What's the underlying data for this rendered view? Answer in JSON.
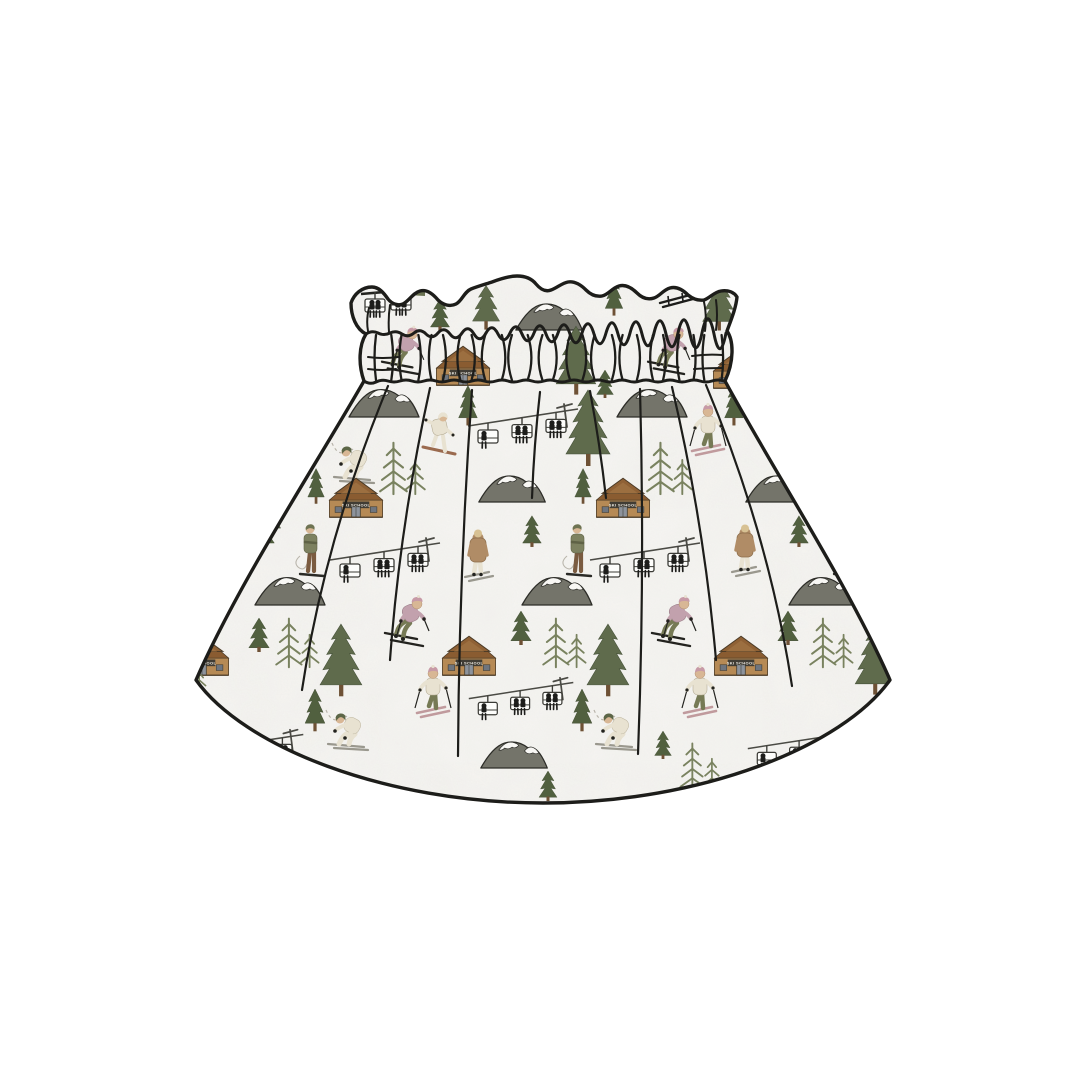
{
  "page": {
    "background": "#ffffff"
  },
  "product": {
    "name": "paperbag-waist-skirt-mockup",
    "print_theme": "ski-resort",
    "cabin_sign_text": "SKI SCHOOL"
  },
  "palette": {
    "fabric": "#f6f5f2",
    "fabric_blotch": "#dcdad4",
    "outline": "#1d1d1a",
    "tree_dark": "#51603f",
    "tree_mid": "#5f6b4c",
    "tree_light": "#79825f",
    "trunk": "#6e5135",
    "mountain": "#74746a",
    "snow": "#f8f7f4",
    "cabin_wall": "#b68a55",
    "cabin_wall_light": "#9c6f40",
    "cabin_roof": "#8f6135",
    "cabin_sign": "#403c34",
    "cabin_sign_text_color": "#efece4",
    "cabin_door": "#8d939c",
    "lift_metal": "#4a4a44",
    "chair_fill": "#fdfdfb",
    "silhouette": "#1d1d1b",
    "jacket_mauve": "#c2a1ad",
    "hat_pink": "#c79aa6",
    "pants_olive": "#767a55",
    "cream": "#e8e2d1",
    "tan_coat": "#b08c66",
    "skin": "#d8b795",
    "hair_blonde": "#d7c193",
    "board_red": "#9a6a4e",
    "ski_pink": "#c09a9d",
    "ski_gray": "#9a988e",
    "sweater_olive": "#7d8160",
    "pants_brown": "#7a5b40",
    "trail": "#b9b5ab"
  },
  "waistband": {
    "x1": 366,
    "x2": 726,
    "top": 334,
    "bottom": 381,
    "fold_count": 26
  },
  "gathers": [
    [
      388,
      386,
      302,
      690,
      -20
    ],
    [
      430,
      388,
      390,
      660,
      -10
    ],
    [
      472,
      390,
      458,
      756,
      -6
    ],
    [
      540,
      392,
      532,
      498,
      -2
    ],
    [
      590,
      391,
      606,
      498,
      2
    ],
    [
      640,
      389,
      638,
      754,
      6
    ],
    [
      672,
      387,
      716,
      660,
      10
    ],
    [
      706,
      385,
      792,
      686,
      20
    ]
  ],
  "motifs": [
    {
      "t": "liftChairs",
      "x": 393,
      "y": 318,
      "s": 1
    },
    {
      "t": "skiRack",
      "x": 676,
      "y": 308,
      "s": 1
    },
    {
      "t": "pineSmall",
      "x": 440,
      "y": 331,
      "s": 0.8
    },
    {
      "t": "spruceMd",
      "x": 486,
      "y": 333,
      "s": 0.85
    },
    {
      "t": "mountain",
      "x": 549,
      "y": 331,
      "s": 0.95
    },
    {
      "t": "spruceThin",
      "x": 614,
      "y": 318,
      "s": 0.8
    },
    {
      "t": "spruceLg",
      "x": 719,
      "y": 335,
      "s": 0.75
    },
    {
      "t": "skierJump",
      "x": 402,
      "y": 375,
      "s": 0.95
    },
    {
      "t": "cabin",
      "x": 463,
      "y": 389,
      "s": 0.95
    },
    {
      "t": "spruceLg",
      "x": 576,
      "y": 400,
      "s": 0.9
    },
    {
      "t": "pineSmall",
      "x": 605,
      "y": 398,
      "s": 0.7
    },
    {
      "t": "skierJump",
      "x": 668,
      "y": 375,
      "s": 0.95
    },
    {
      "t": "cabin",
      "x": 740,
      "y": 392,
      "s": 0.95
    },
    {
      "t": "mountain",
      "x": 384,
      "y": 418,
      "s": 1
    },
    {
      "t": "mountain",
      "x": 652,
      "y": 418,
      "s": 1
    },
    {
      "t": "snowboarder",
      "x": 440,
      "y": 457,
      "s": 1
    },
    {
      "t": "chairlift",
      "x": 523,
      "y": 458,
      "s": 1
    },
    {
      "t": "spruceLg",
      "x": 588,
      "y": 472,
      "s": 1
    },
    {
      "t": "spruceThin",
      "x": 468,
      "y": 428,
      "s": 0.85
    },
    {
      "t": "spruceThin",
      "x": 734,
      "y": 428,
      "s": 0.85
    },
    {
      "t": "skierSlalom",
      "x": 708,
      "y": 458,
      "s": 1
    },
    {
      "t": "skierCrouch",
      "x": 354,
      "y": 483,
      "s": 1
    },
    {
      "t": "spruceMd",
      "x": 851,
      "y": 470,
      "s": 0.9
    },
    {
      "t": "sparsePair",
      "x": 402,
      "y": 496,
      "s": 0.95
    },
    {
      "t": "sparsePair",
      "x": 669,
      "y": 496,
      "s": 0.95
    },
    {
      "t": "spruceThin",
      "x": 316,
      "y": 506,
      "s": 0.75
    },
    {
      "t": "spruceThin",
      "x": 583,
      "y": 506,
      "s": 0.75
    },
    {
      "t": "spruceThin",
      "x": 850,
      "y": 506,
      "s": 0.75
    },
    {
      "t": "mountain",
      "x": 245,
      "y": 503,
      "s": 0.95
    },
    {
      "t": "mountain",
      "x": 512,
      "y": 503,
      "s": 0.95
    },
    {
      "t": "mountain",
      "x": 779,
      "y": 503,
      "s": 0.95
    },
    {
      "t": "cabin",
      "x": 356,
      "y": 521,
      "s": 0.95
    },
    {
      "t": "cabin",
      "x": 623,
      "y": 521,
      "s": 0.95
    },
    {
      "t": "cabin",
      "x": 884,
      "y": 521,
      "s": 0.95
    },
    {
      "t": "spruceMd",
      "x": 267,
      "y": 540,
      "s": 0.85
    },
    {
      "t": "pineSmall",
      "x": 532,
      "y": 547,
      "s": 0.78
    },
    {
      "t": "pineSmall",
      "x": 265,
      "y": 547,
      "s": 0.78
    },
    {
      "t": "pineSmall",
      "x": 799,
      "y": 547,
      "s": 0.78
    },
    {
      "t": "walker",
      "x": 478,
      "y": 583,
      "s": 1
    },
    {
      "t": "walker",
      "x": 211,
      "y": 583,
      "s": 1
    },
    {
      "t": "walker",
      "x": 745,
      "y": 578,
      "s": 1
    },
    {
      "t": "stander",
      "x": 578,
      "y": 580,
      "s": 1
    },
    {
      "t": "stander",
      "x": 311,
      "y": 580,
      "s": 1
    },
    {
      "t": "stander",
      "x": 845,
      "y": 580,
      "s": 1
    },
    {
      "t": "chairlift",
      "x": 385,
      "y": 592,
      "s": 1
    },
    {
      "t": "chairlift",
      "x": 645,
      "y": 592,
      "s": 1
    },
    {
      "t": "mountain",
      "x": 290,
      "y": 606,
      "s": 1
    },
    {
      "t": "mountain",
      "x": 557,
      "y": 606,
      "s": 1
    },
    {
      "t": "mountain",
      "x": 824,
      "y": 606,
      "s": 1
    },
    {
      "t": "skierJump",
      "x": 406,
      "y": 647,
      "s": 1
    },
    {
      "t": "skierJump",
      "x": 673,
      "y": 647,
      "s": 1
    },
    {
      "t": "pineSmall",
      "x": 259,
      "y": 652,
      "s": 0.85
    },
    {
      "t": "pineSmall",
      "x": 521,
      "y": 645,
      "s": 0.85
    },
    {
      "t": "pineSmall",
      "x": 788,
      "y": 645,
      "s": 0.85
    },
    {
      "t": "cabin",
      "x": 469,
      "y": 679,
      "s": 0.95
    },
    {
      "t": "cabin",
      "x": 741,
      "y": 679,
      "s": 0.95
    },
    {
      "t": "cabin",
      "x": 202,
      "y": 679,
      "s": 0.95
    },
    {
      "t": "sparsePair",
      "x": 297,
      "y": 669,
      "s": 0.9
    },
    {
      "t": "sparsePair",
      "x": 564,
      "y": 669,
      "s": 0.9
    },
    {
      "t": "sparsePair",
      "x": 831,
      "y": 669,
      "s": 0.9
    },
    {
      "t": "spruceLg",
      "x": 341,
      "y": 702,
      "s": 0.95
    },
    {
      "t": "spruceLg",
      "x": 608,
      "y": 702,
      "s": 0.95
    },
    {
      "t": "spruceLg",
      "x": 875,
      "y": 700,
      "s": 0.9
    },
    {
      "t": "sparsePair",
      "x": 188,
      "y": 700,
      "s": 0.8
    },
    {
      "t": "skierSlalom",
      "x": 433,
      "y": 720,
      "s": 1
    },
    {
      "t": "skierSlalom",
      "x": 700,
      "y": 720,
      "s": 1
    },
    {
      "t": "spruceThin",
      "x": 582,
      "y": 734,
      "s": 0.9
    },
    {
      "t": "spruceThin",
      "x": 315,
      "y": 734,
      "s": 0.9
    },
    {
      "t": "chairlift",
      "x": 521,
      "y": 729,
      "s": 0.95
    },
    {
      "t": "chairlift",
      "x": 251,
      "y": 781,
      "s": 0.95
    },
    {
      "t": "chairlift",
      "x": 800,
      "y": 779,
      "s": 0.95
    },
    {
      "t": "skierCrouch",
      "x": 616,
      "y": 750,
      "s": 1
    },
    {
      "t": "skierCrouch",
      "x": 348,
      "y": 750,
      "s": 1
    },
    {
      "t": "mountain",
      "x": 514,
      "y": 769,
      "s": 0.95
    },
    {
      "t": "pineSmall",
      "x": 663,
      "y": 759,
      "s": 0.7
    },
    {
      "t": "sparsePair",
      "x": 700,
      "y": 791,
      "s": 0.85
    },
    {
      "t": "pineSmall",
      "x": 548,
      "y": 801,
      "s": 0.75
    }
  ]
}
